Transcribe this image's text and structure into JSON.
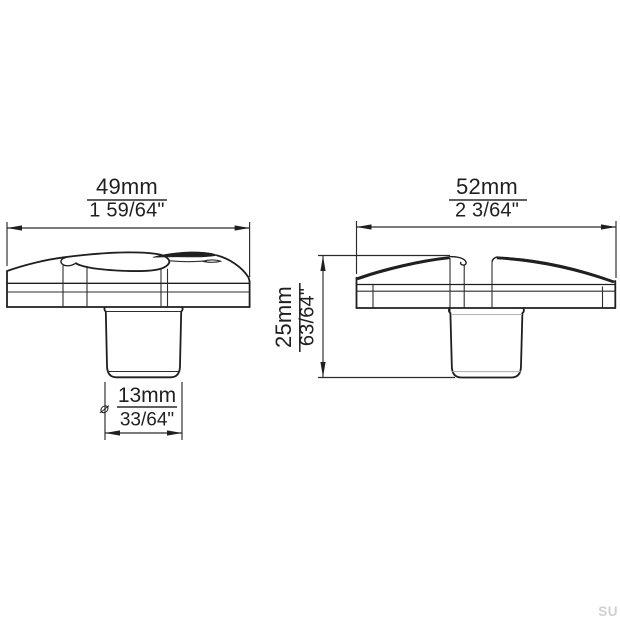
{
  "title": "furniture-knob-dimension-drawing",
  "front_view": {
    "width_dim": {
      "value_mm": "49mm",
      "value_in": "1 59/64\""
    },
    "stem_dim": {
      "diameter_symbol": "⌀",
      "value_mm": "13mm",
      "value_in": "33/64\""
    }
  },
  "side_view": {
    "width_dim": {
      "value_mm": "52mm",
      "value_in": "2 3/64\""
    },
    "height_dim": {
      "value_mm": "25mm",
      "value_in": "63/64\""
    }
  },
  "watermark": "SU",
  "colors": {
    "line": "#1f1f1f",
    "dimension_line": "#2a2a2a",
    "accent_line": "#b3b3b3",
    "text": "#1f1f1f",
    "watermark": "#cfd0d2",
    "background": "#ffffff"
  }
}
